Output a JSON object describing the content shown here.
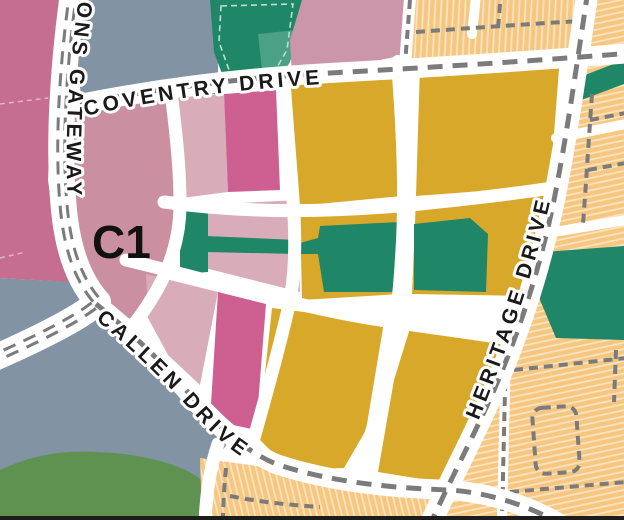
{
  "map": {
    "streets": {
      "coventry": {
        "name": "COVENTRY DRIVE"
      },
      "callen": {
        "name": "CALLEN DRIVE"
      },
      "heritage": {
        "name": "HERITAGE DRIVE"
      },
      "gateway": {
        "name": "SONS GATEWAY"
      }
    },
    "zone": {
      "label": "C1"
    },
    "colors": {
      "road": "#ffffff",
      "label_text": "#1a1a1a",
      "parcel_pink_dark": "#c66e8f",
      "parcel_pink_medium": "#cb8fa2",
      "parcel_pink_light": "#d9acba",
      "parcel_magenta": "#cd6090",
      "parcel_mauve": "#cb95aa",
      "parcel_gold": "#d8a82a",
      "parcel_orange": "#f6c781",
      "parcel_gray": "#8293a3",
      "parcel_green": "#5f9150",
      "park_teal": "#1f8667",
      "park_teal_light": "#4aa186",
      "road_dash": "#7b7b7b",
      "lane_dash": "#7b7b7b",
      "park_outline_dash": "#b9e0cd",
      "parcel_boundary_dash": "#e0b6c5",
      "map_edge_dark": "#1c1c1c"
    }
  }
}
